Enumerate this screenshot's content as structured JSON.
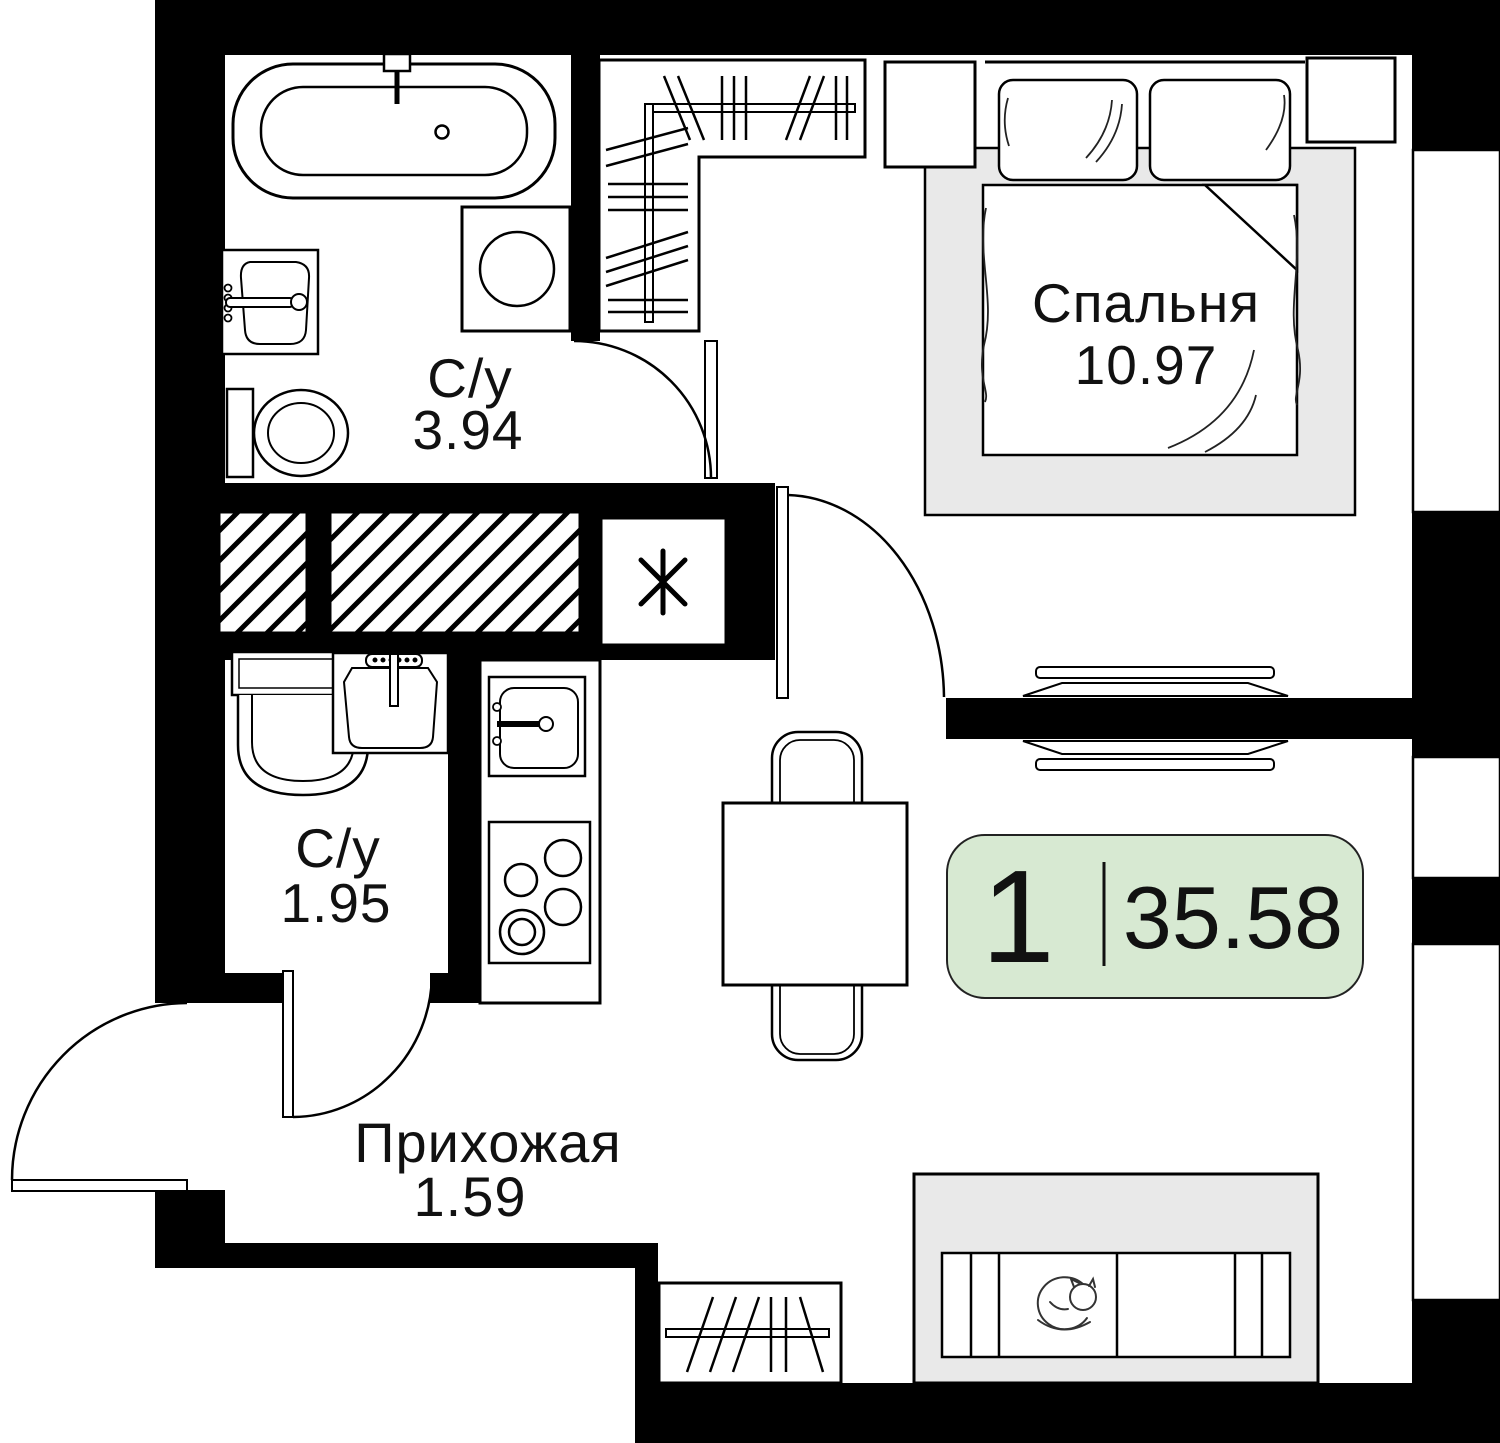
{
  "badge": {
    "room_count": "1",
    "total_area": "35.58",
    "fill": "#d7e9d2"
  },
  "rooms": {
    "bedroom": {
      "name": "Спальня",
      "area": "10.97"
    },
    "bathroom_top": {
      "name": "С/у",
      "area": "3.94"
    },
    "bathroom_bottom": {
      "name": "С/у",
      "area": "1.95"
    },
    "hallway": {
      "name": "Прихожая",
      "area": "1.59"
    }
  },
  "colors": {
    "wall": "#000000",
    "furniture_gray": "#e9e9e9",
    "line": "#111111"
  }
}
